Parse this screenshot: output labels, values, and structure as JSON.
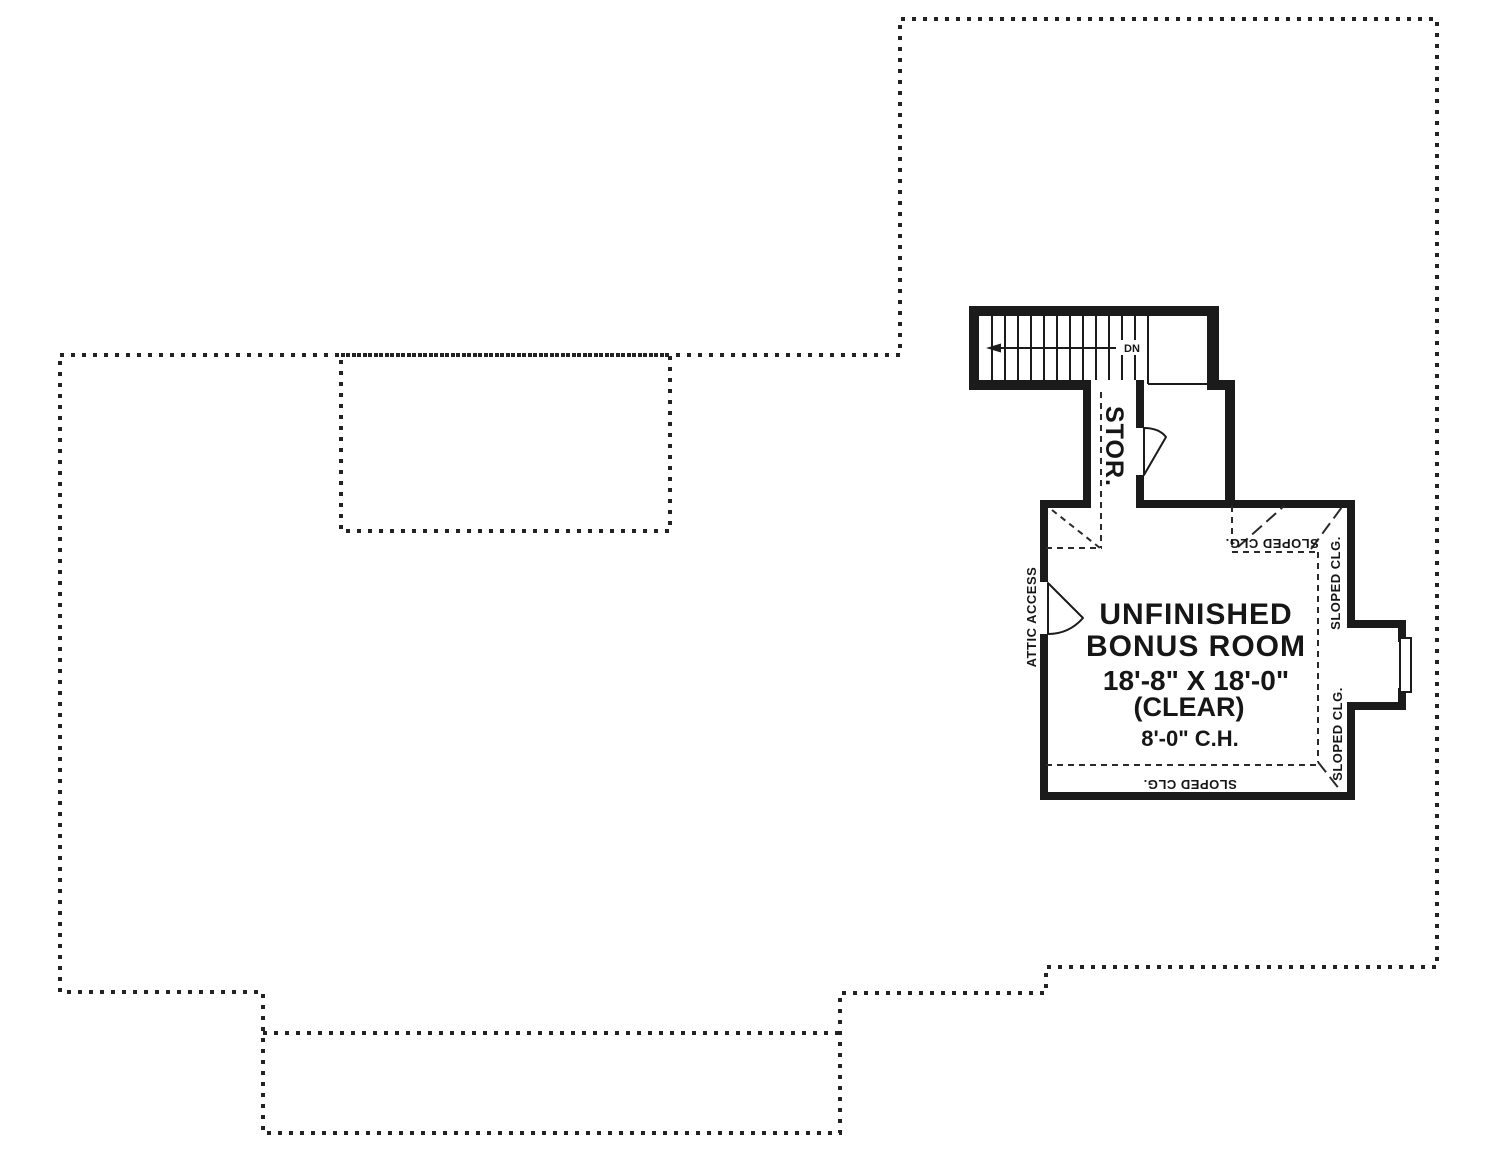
{
  "plan": {
    "room": {
      "name_line1": "UNFINISHED",
      "name_line2": "BONUS ROOM",
      "dimensions": "18'-8\" X 18'-0\"",
      "clear_note": "(CLEAR)",
      "ceiling_height": "8'-0\" C.H."
    },
    "labels": {
      "storage": "STOR.",
      "down": "DN",
      "attic_access": "ATTIC ACCESS",
      "sloped_ceiling": "SLOPED CLG."
    },
    "colors": {
      "line": "#1b1b1b",
      "roof_outline": "#222222",
      "background": "#ffffff"
    }
  }
}
